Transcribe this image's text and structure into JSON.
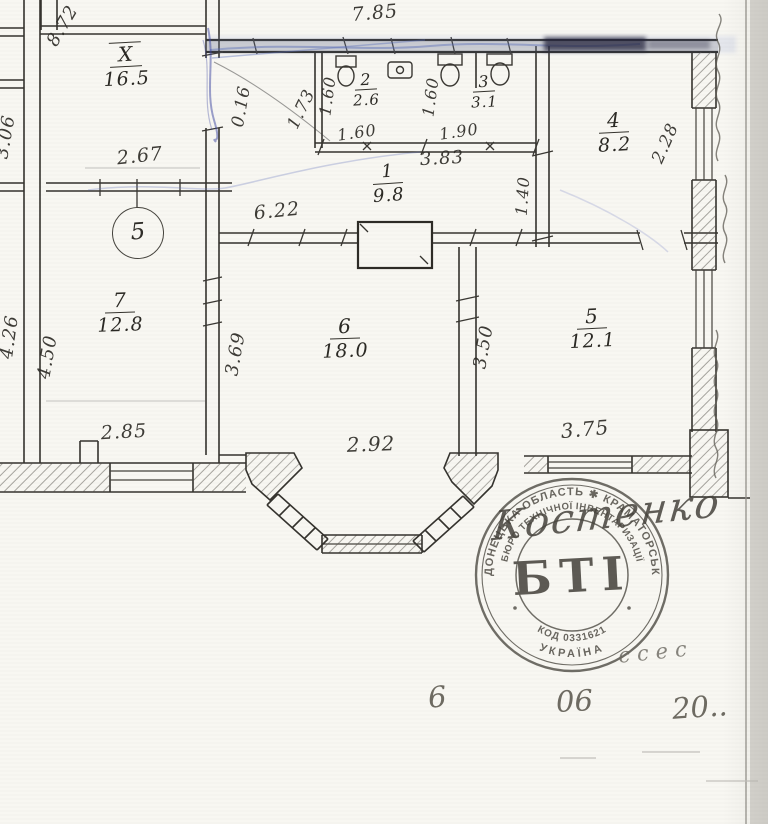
{
  "plan": {
    "unit_marker": "5",
    "rooms": [
      {
        "id": "X",
        "area": "16.5"
      },
      {
        "id": "1",
        "area": "9.8"
      },
      {
        "id": "2",
        "area": "2.6"
      },
      {
        "id": "3",
        "area": "3.1"
      },
      {
        "id": "4",
        "area": "8.2"
      },
      {
        "id": "5",
        "area": "12.1"
      },
      {
        "id": "6",
        "area": "18.0"
      },
      {
        "id": "7",
        "area": "12.8"
      }
    ],
    "dimensions": {
      "top_total": "7.85",
      "left_top": "8.72",
      "left_edge_partial": "3.06",
      "room_x_width": "2.67",
      "door_width": "0.16",
      "entry_width": "1.73",
      "room2_depth": "1.60",
      "room2_width": "1.60",
      "room3_depth": "1.60",
      "room3_width": "1.90",
      "rooms23_total": "3.83",
      "hall_width": "6.22",
      "partition": "1.40",
      "room4_depth": "2.28",
      "room7_outer": "4.26",
      "room7_depth": "4.50",
      "room7_width": "2.85",
      "wall_7_6": "3.69",
      "room6_width": "2.92",
      "wall_6_5": "3.50",
      "room5_width": "3.75"
    }
  },
  "stamp": {
    "ring_outer": "ДОНЕЦЬКА ОБЛАСТЬ ✱ КРАМАТОРСЬК",
    "ring_inner": "БЮРО ТЕХНІЧНОЇ ІНВЕНТАРИЗАЦІЇ",
    "code": "КОД 0331621",
    "country": "УКРАЇНА",
    "abbr": "БТІ"
  },
  "handwritten": {
    "signature": "Костенко",
    "flourish": "ссес",
    "date_day": "6",
    "date_month": "06",
    "date_year": "20.."
  }
}
